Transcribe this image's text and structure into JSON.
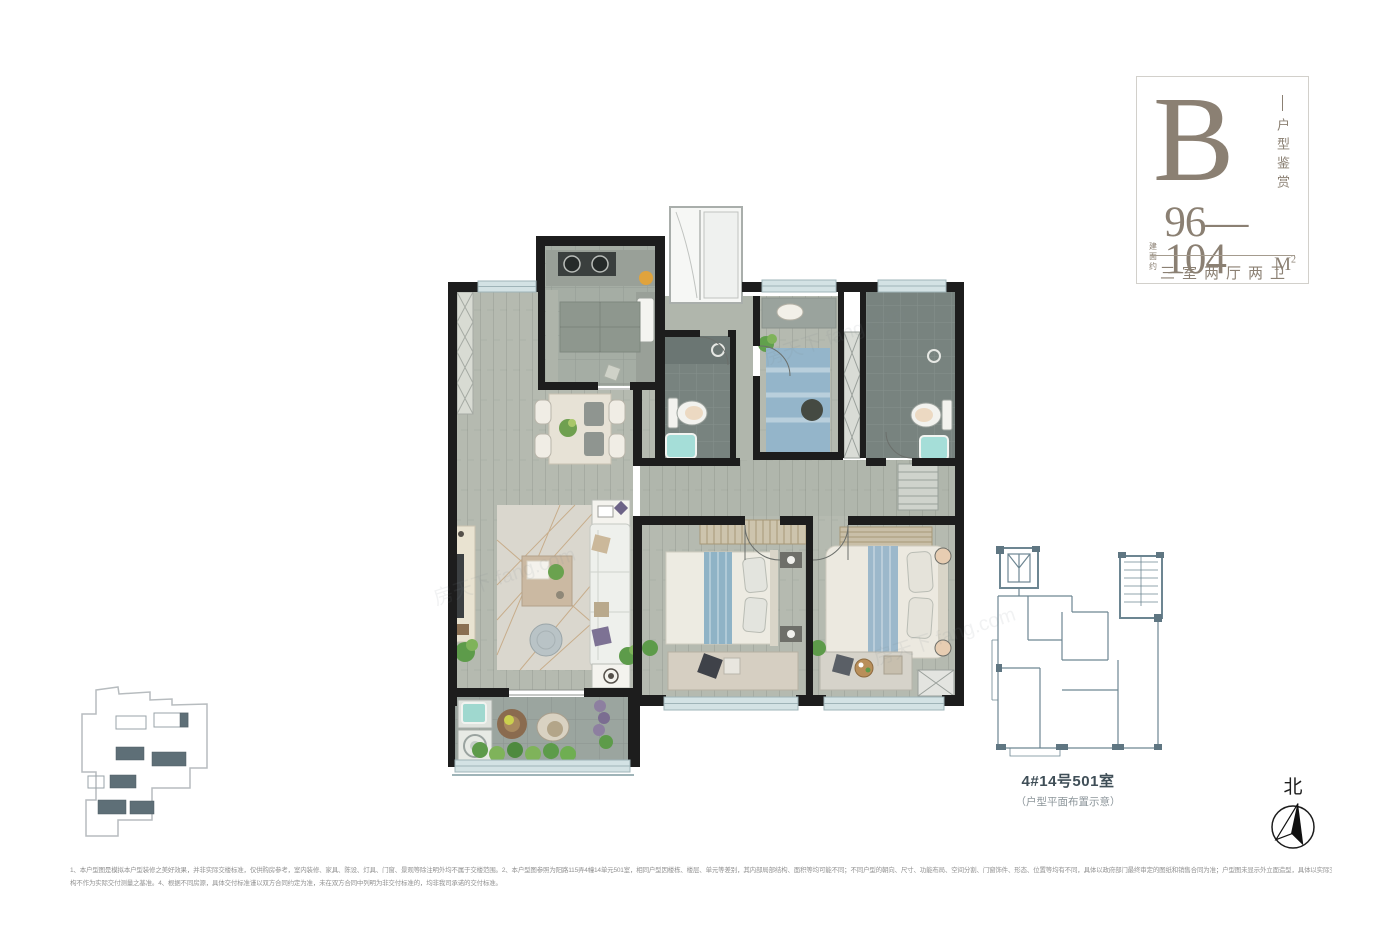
{
  "info_card": {
    "type_letter": "B",
    "series_label": "户型鉴赏",
    "area_prefix_line1": "建面",
    "area_prefix_line2": "约",
    "area_value": "96—104",
    "area_unit": "M",
    "area_unit_sup": "2",
    "layout_text": "三室两厅两卫",
    "accent_color": "#8b8073"
  },
  "key_plan": {
    "label": "4#14号501室",
    "sublabel": "（户型平面布置示意）"
  },
  "compass": {
    "label": "北"
  },
  "disclaimer": {
    "line1": "1、本户型图是模拟本户型装修之美好效果，并非实际交楼标准，仅供购房参考，室内装修、家具、陈设、灯具、门窗、景观等除注明外均不属于交楼范围。2、本户型图参照为阳路115弄4幢14单元501室，相同户型因楼栋、楼层、单元等差别，其内部局部结构、面积等均可能不同；不同户型的朝向、尺寸、功能布局、空间分割、门窗饰件、形态、位置等均有不同，具体以政府部门最终审定的图纸和销售合同为准；户型图未显示外立面造型，具体以实际交付为准。3、本单位室内外所有标高差距、尺寸及建筑结",
    "line2": "构不作为实际交付测量之基准。4、根据不同房源，具体交付标准谨以双方合同约定为准，未在双方合同中列明为非交付标准的，均非我司承诺的交付标准。"
  },
  "watermark": {
    "text": "房天下 fang.com"
  },
  "floor_plan": {
    "rooms": [
      "厨房",
      "客厅餐厅",
      "卫生间",
      "小卧室",
      "主卫",
      "次卧",
      "主卧",
      "阳台",
      "玄关",
      "过道"
    ],
    "colors": {
      "wall": "#1d1d1d",
      "wood_floor": "#b5bab0",
      "kitchen_tile": "#a5ada4",
      "bath_tile": "#78837f",
      "balcony_tile": "#9ba59f",
      "window": "#d3e2e4",
      "teal_fixture": "#a5ded8",
      "bed_blue": "#94b5ca",
      "rug": "#dad7ce",
      "plant_green": "#61a04d",
      "site_plan_fill": "#5e6f77",
      "key_plan_stroke": "#6d8692"
    }
  }
}
